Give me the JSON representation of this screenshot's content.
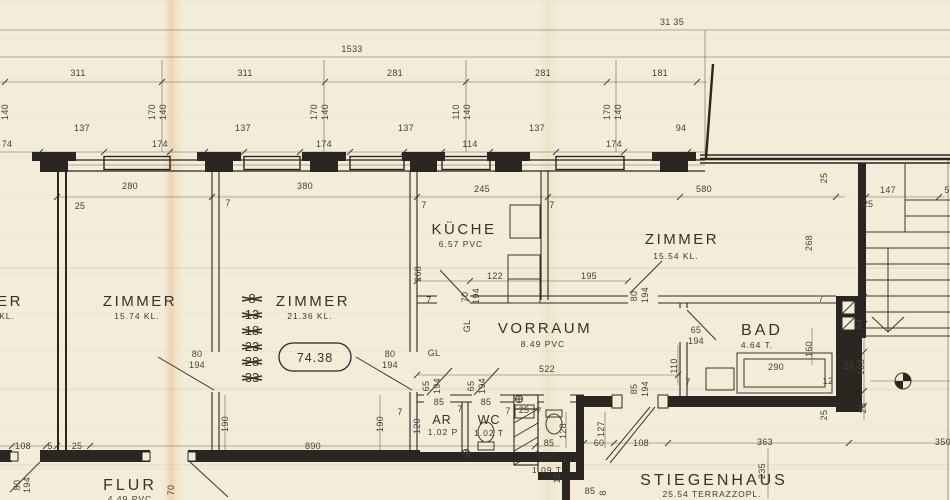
{
  "drawing": {
    "type": "apartment floor plan",
    "total_area_oval": "74.38",
    "colors": {
      "paper": "#f2ecd8",
      "ink": "#35322b",
      "wall": "#2a2722",
      "dim_text": "#45413a",
      "fold_crease": "#e08c3c"
    }
  },
  "rooms": [
    {
      "id": "zimmer-left",
      "name": "ZIMMER",
      "detail": "15.74  KL."
    },
    {
      "id": "zimmer-center",
      "name": "ZIMMER",
      "detail": "21.36  KL."
    },
    {
      "id": "kueche",
      "name": "KÜCHE",
      "detail": "6.57  PVC"
    },
    {
      "id": "zimmer-right",
      "name": "ZIMMER",
      "detail": "15.54  KL."
    },
    {
      "id": "vorraum",
      "name": "VORRAUM",
      "detail": "8.49  PVC"
    },
    {
      "id": "bad",
      "name": "BAD",
      "detail": "4.64  T."
    },
    {
      "id": "abstellraum",
      "name": "AR",
      "detail": "1.02 P"
    },
    {
      "id": "wc-1",
      "name": "WC",
      "detail": "1.02 T"
    },
    {
      "id": "wc-2",
      "name": "WC",
      "detail": "1.09 T"
    },
    {
      "id": "flur",
      "name": "FLUR",
      "detail": "4.49 PVC"
    },
    {
      "id": "stiegenhaus",
      "name": "STIEGENHAUS",
      "detail": "25.54  TERRAZZOPL."
    },
    {
      "id": "neighbor-room-cut",
      "name": "ER",
      "detail": "KL."
    }
  ],
  "revision_numbers": {
    "note": "struck-through flat numbers",
    "x": 252,
    "ys": [
      303,
      319,
      335,
      351,
      366,
      382
    ],
    "values": [
      "8",
      "13",
      "18",
      "23",
      "28",
      "33"
    ]
  },
  "dims": [
    {
      "t": "31 35",
      "x": 672,
      "y": 25,
      "fs": 10
    },
    {
      "t": "1533",
      "x": 352,
      "y": 52,
      "fs": 10
    },
    {
      "t": "311",
      "x": 78,
      "y": 76
    },
    {
      "t": "311",
      "x": 245,
      "y": 76
    },
    {
      "t": "281",
      "x": 395,
      "y": 76
    },
    {
      "t": "281",
      "x": 543,
      "y": 76
    },
    {
      "t": "181",
      "x": 660,
      "y": 76
    },
    {
      "t": "140",
      "x": 8,
      "y": 112,
      "r": 1
    },
    {
      "t": "170",
      "x": 155,
      "y": 112,
      "r": 1
    },
    {
      "t": "140",
      "x": 166,
      "y": 112,
      "r": 1
    },
    {
      "t": "170",
      "x": 317,
      "y": 112,
      "r": 1
    },
    {
      "t": "140",
      "x": 328,
      "y": 112,
      "r": 1
    },
    {
      "t": "110",
      "x": 459,
      "y": 112,
      "r": 1
    },
    {
      "t": "140",
      "x": 470,
      "y": 112,
      "r": 1
    },
    {
      "t": "170",
      "x": 610,
      "y": 112,
      "r": 1
    },
    {
      "t": "140",
      "x": 621,
      "y": 112,
      "r": 1
    },
    {
      "t": "137",
      "x": 82,
      "y": 131
    },
    {
      "t": "137",
      "x": 243,
      "y": 131
    },
    {
      "t": "137",
      "x": 406,
      "y": 131
    },
    {
      "t": "137",
      "x": 537,
      "y": 131
    },
    {
      "t": "94",
      "x": 681,
      "y": 131
    },
    {
      "t": "74",
      "x": 7,
      "y": 147
    },
    {
      "t": "174",
      "x": 160,
      "y": 147
    },
    {
      "t": "174",
      "x": 324,
      "y": 147
    },
    {
      "t": "114",
      "x": 470,
      "y": 147
    },
    {
      "t": "174",
      "x": 614,
      "y": 147
    },
    {
      "t": "280",
      "x": 130,
      "y": 189
    },
    {
      "t": "25",
      "x": 80,
      "y": 209
    },
    {
      "t": "380",
      "x": 305,
      "y": 189
    },
    {
      "t": "7",
      "x": 228,
      "y": 206
    },
    {
      "t": "245",
      "x": 482,
      "y": 192
    },
    {
      "t": "7",
      "x": 424,
      "y": 208
    },
    {
      "t": "7",
      "x": 552,
      "y": 208
    },
    {
      "t": "580",
      "x": 704,
      "y": 192
    },
    {
      "t": "25",
      "x": 827,
      "y": 178,
      "r": 1
    },
    {
      "t": "147",
      "x": 888,
      "y": 193
    },
    {
      "t": "25",
      "x": 868,
      "y": 207
    },
    {
      "t": "5",
      "x": 947,
      "y": 193
    },
    {
      "t": "268",
      "x": 421,
      "y": 274,
      "r": 1
    },
    {
      "t": "268",
      "x": 812,
      "y": 243,
      "r": 1
    },
    {
      "t": "122",
      "x": 495,
      "y": 279
    },
    {
      "t": "195",
      "x": 589,
      "y": 279
    },
    {
      "t": "70",
      "x": 468,
      "y": 297,
      "r": 1
    },
    {
      "t": "194",
      "x": 479,
      "y": 296,
      "r": 1
    },
    {
      "t": "80",
      "x": 637,
      "y": 296,
      "r": 1
    },
    {
      "t": "194",
      "x": 648,
      "y": 295,
      "r": 1
    },
    {
      "t": "7",
      "x": 429,
      "y": 303
    },
    {
      "t": "7",
      "x": 821,
      "y": 302
    },
    {
      "t": "80",
      "x": 197,
      "y": 357
    },
    {
      "t": "194",
      "x": 197,
      "y": 368
    },
    {
      "t": "80",
      "x": 390,
      "y": 357
    },
    {
      "t": "194",
      "x": 390,
      "y": 368
    },
    {
      "t": "GL",
      "x": 470,
      "y": 326,
      "r": 1
    },
    {
      "t": "GL",
      "x": 434,
      "y": 356
    },
    {
      "t": "522",
      "x": 547,
      "y": 372
    },
    {
      "t": "65",
      "x": 429,
      "y": 386,
      "r": 1
    },
    {
      "t": "194",
      "x": 440,
      "y": 386,
      "r": 1
    },
    {
      "t": "65",
      "x": 474,
      "y": 386,
      "r": 1
    },
    {
      "t": "194",
      "x": 485,
      "y": 386,
      "r": 1
    },
    {
      "t": "85",
      "x": 637,
      "y": 389,
      "r": 1
    },
    {
      "t": "194",
      "x": 648,
      "y": 389,
      "r": 1
    },
    {
      "t": "110",
      "x": 677,
      "y": 366,
      "r": 1
    },
    {
      "t": "7",
      "x": 688,
      "y": 385
    },
    {
      "t": "65",
      "x": 696,
      "y": 333
    },
    {
      "t": "194",
      "x": 696,
      "y": 344
    },
    {
      "t": "290",
      "x": 776,
      "y": 370
    },
    {
      "t": "12",
      "x": 828,
      "y": 384
    },
    {
      "t": "26",
      "x": 849,
      "y": 369
    },
    {
      "t": "160",
      "x": 812,
      "y": 349,
      "r": 1
    },
    {
      "t": "103",
      "x": 864,
      "y": 367,
      "r": 1
    },
    {
      "t": "64",
      "x": 862,
      "y": 324,
      "r": 1
    },
    {
      "t": "25",
      "x": 866,
      "y": 408,
      "r": 1
    },
    {
      "t": "25",
      "x": 827,
      "y": 415,
      "r": 1
    },
    {
      "t": "190",
      "x": 228,
      "y": 424,
      "r": 1
    },
    {
      "t": "190",
      "x": 383,
      "y": 424,
      "r": 1
    },
    {
      "t": "120",
      "x": 420,
      "y": 426,
      "r": 1
    },
    {
      "t": "85",
      "x": 439,
      "y": 405
    },
    {
      "t": "85",
      "x": 486,
      "y": 405
    },
    {
      "t": "7",
      "x": 400,
      "y": 415
    },
    {
      "t": "7",
      "x": 460,
      "y": 412
    },
    {
      "t": "7",
      "x": 508,
      "y": 414
    },
    {
      "t": "25",
      "x": 524,
      "y": 413
    },
    {
      "t": "7",
      "x": 539,
      "y": 414
    },
    {
      "t": "85",
      "x": 549,
      "y": 446
    },
    {
      "t": "128",
      "x": 566,
      "y": 431,
      "r": 1
    },
    {
      "t": "12",
      "x": 560,
      "y": 478,
      "r": 1
    },
    {
      "t": "127",
      "x": 604,
      "y": 429,
      "r": 1
    },
    {
      "t": "60",
      "x": 599,
      "y": 446
    },
    {
      "t": "108",
      "x": 641,
      "y": 446
    },
    {
      "t": "363",
      "x": 765,
      "y": 445
    },
    {
      "t": "350",
      "x": 943,
      "y": 445
    },
    {
      "t": "235",
      "x": 765,
      "y": 471,
      "r": 1
    },
    {
      "t": "85",
      "x": 590,
      "y": 494
    },
    {
      "t": "8",
      "x": 606,
      "y": 493,
      "r": 1
    },
    {
      "t": "108",
      "x": 23,
      "y": 449
    },
    {
      "t": "5",
      "x": 50,
      "y": 449
    },
    {
      "t": "25",
      "x": 77,
      "y": 449
    },
    {
      "t": "890",
      "x": 313,
      "y": 449
    },
    {
      "t": "80",
      "x": 20,
      "y": 485,
      "r": 1
    },
    {
      "t": "194",
      "x": 30,
      "y": 485,
      "r": 1
    },
    {
      "t": "70",
      "x": 174,
      "y": 490,
      "r": 1
    }
  ]
}
